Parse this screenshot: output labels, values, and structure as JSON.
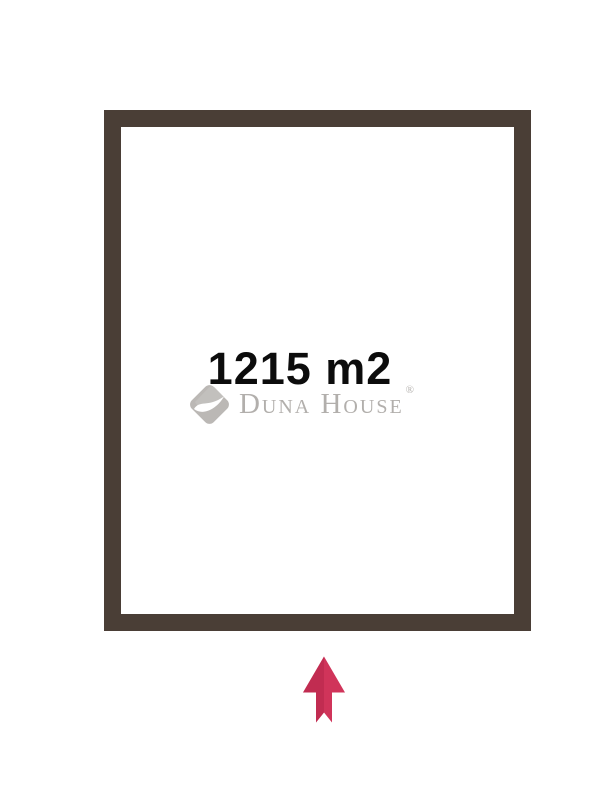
{
  "plot": {
    "area_label": "1215 m2"
  },
  "watermark": {
    "brand": "Duna House",
    "registered_mark": "®"
  },
  "icons": {
    "logo": "duna-house-logo-icon",
    "compass": "north-arrow-icon"
  },
  "colors": {
    "background": "#ffffff",
    "border-brown": "#4a3e36",
    "area-text": "#0c0c0c",
    "watermark-gray": "#b2afac",
    "logo-gray": "#bbb8b5",
    "logo-gray-light": "#c9c6c3",
    "arrow-red": "#d0345a",
    "arrow-red-dark": "#b8284b"
  }
}
